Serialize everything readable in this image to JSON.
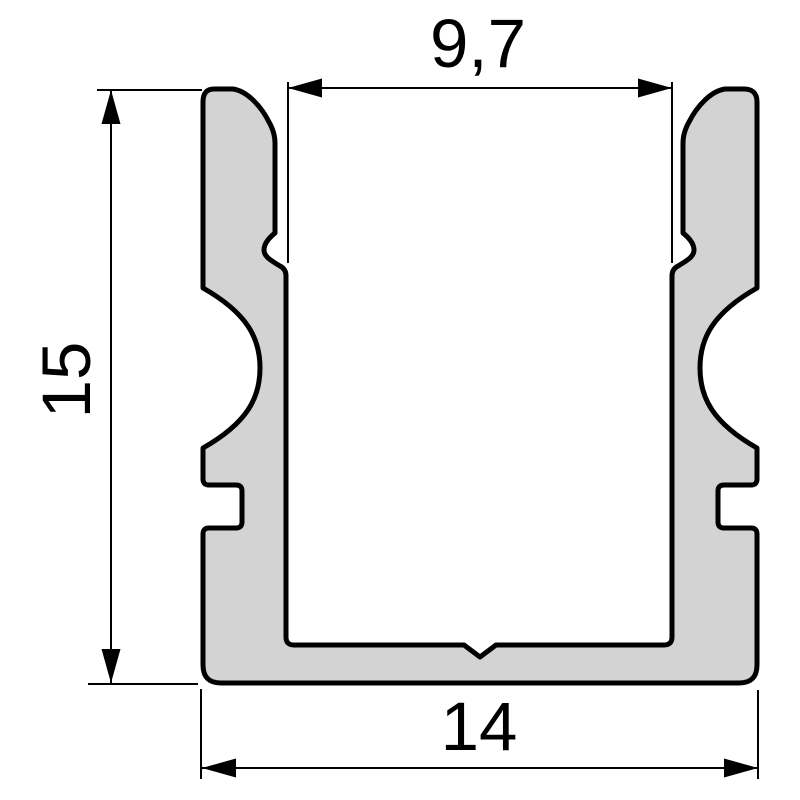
{
  "diagram": {
    "type": "technical-cross-section",
    "labels": {
      "inner_width": "9,7",
      "height": "15",
      "outer_width": "14"
    },
    "colors": {
      "profile_fill": "#d3d3d3",
      "line": "#000000",
      "background": "#ffffff"
    }
  }
}
